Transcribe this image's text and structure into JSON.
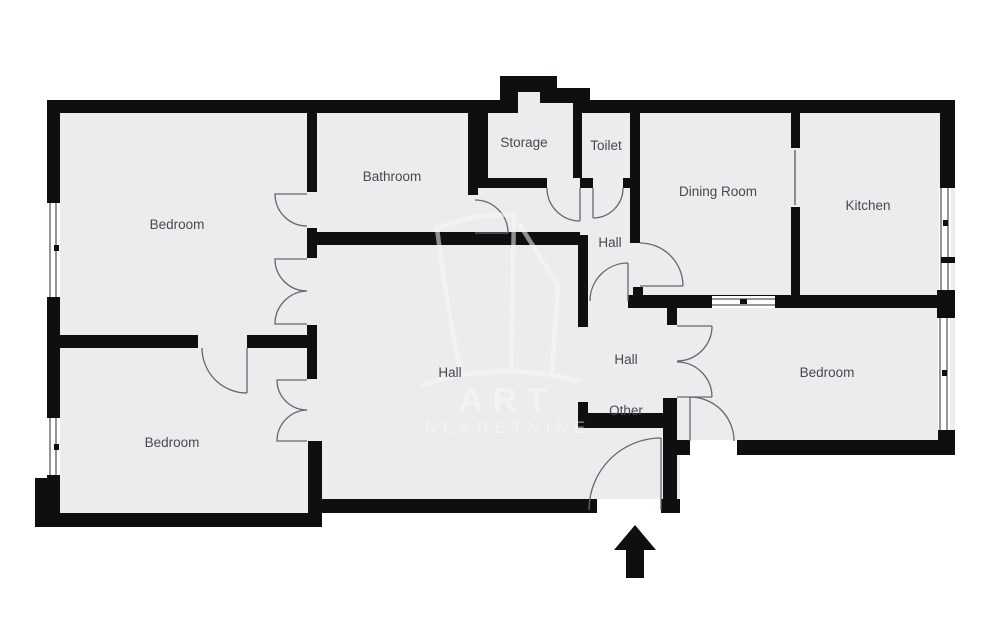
{
  "floorplan": {
    "rooms": {
      "bedroom_nw": "Bedroom",
      "bedroom_sw": "Bedroom",
      "bedroom_e": "Bedroom",
      "bathroom": "Bathroom",
      "storage": "Storage",
      "toilet": "Toilet",
      "dining_room": "Dining Room",
      "kitchen": "Kitchen",
      "hall_upper": "Hall",
      "hall_main": "Hall",
      "hall_east": "Hall",
      "other": "Other"
    },
    "watermark": {
      "line1": "ART",
      "line2": "NEKRETNINE"
    },
    "colors": {
      "background": "#ffffff",
      "floor": "#ebecee",
      "wall": "#0e0f10",
      "door_line": "#63686d",
      "glazing_line": "#2b2e30",
      "label": "#46494e",
      "watermark": "#f7f8f9"
    }
  }
}
